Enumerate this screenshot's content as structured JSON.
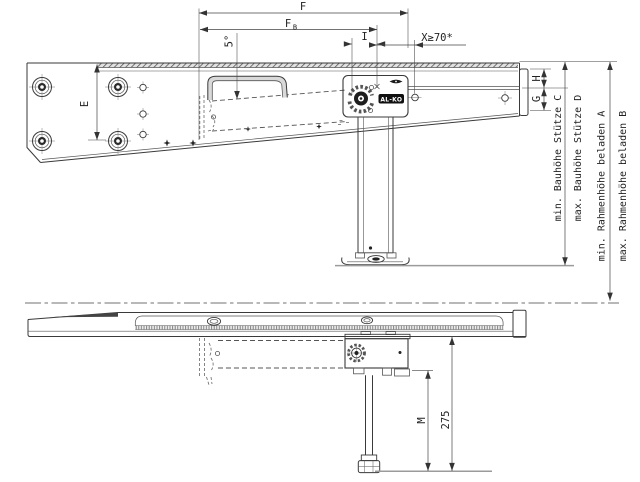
{
  "drawing": {
    "kind": "technical installation drawing",
    "subject": "AL-KO support jack mounted on trailer chassis frame, side elevation (extended) and side view (retracted with crank)",
    "brand_logo": "AL-KO",
    "line_color": "#3a3a3a",
    "ground_color": "#9b9b9b"
  },
  "dims": {
    "F": "F",
    "FB_main": "F",
    "FB_sub": "B",
    "I": "I",
    "X_min": "X≥70*",
    "angle": "5°",
    "E": "E",
    "H": "H",
    "G": "G",
    "M": "M",
    "len_275": "275",
    "bauhoehe_min": "min. Bauhöhe Stütze C",
    "bauhoehe_max": "max. Bauhöhe Stütze D",
    "rahmenhoehe_min": "min. Rahmenhöhe beladen A",
    "rahmenhoehe_max": "max. Rahmenhöhe beladen B"
  }
}
